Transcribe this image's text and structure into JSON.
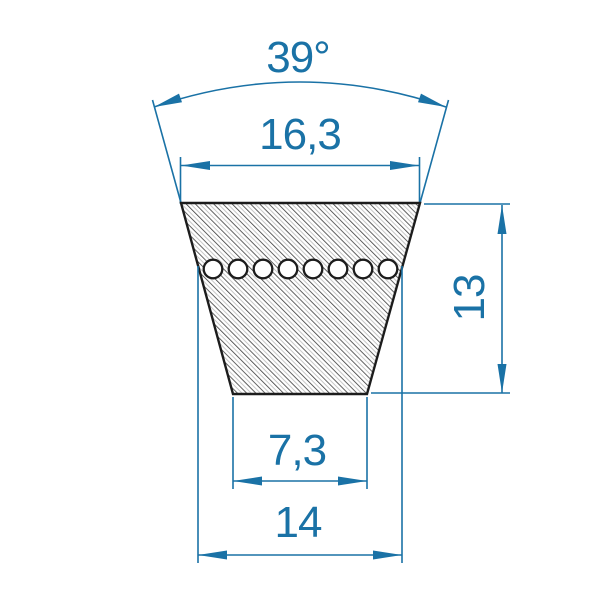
{
  "title": "V-belt cross-section dimension drawing",
  "colors": {
    "dimension_blue": "#1a72a6",
    "outline_black": "#1c1c1c",
    "hatch_dark": "#3a3a3a",
    "hatch_light": "#b8b8b8"
  },
  "labels": {
    "angle": "39°",
    "top_width": "16,3",
    "height": "13",
    "bottom_width": "7,3",
    "datum_width": "14"
  },
  "dimensions": {
    "angle_degrees": 39,
    "top_width": 16.3,
    "height": 13,
    "bottom_width": 7.3,
    "datum_width": 14
  },
  "cord_line": {
    "circle_count": 8
  }
}
